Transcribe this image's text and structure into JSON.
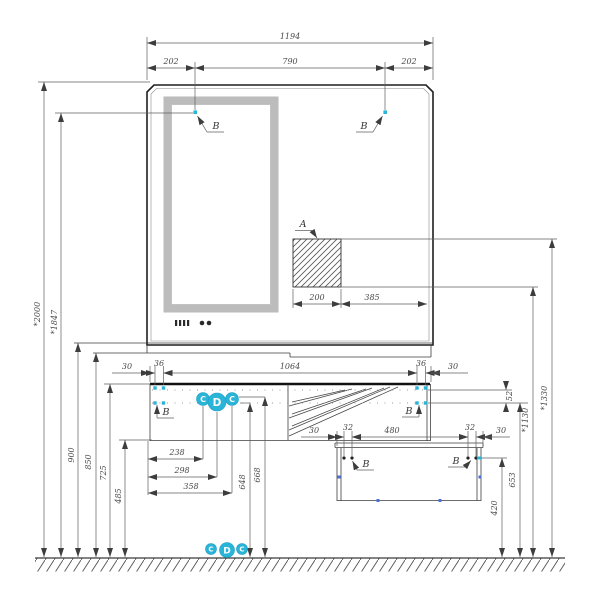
{
  "drawing": {
    "callouts": {
      "a": "A",
      "b": "B",
      "c": "C",
      "d": "D"
    },
    "top_dims": {
      "total": "1194",
      "left": "202",
      "center": "790",
      "right": "202"
    },
    "hatch_dims": {
      "width": "200",
      "offset": "385"
    },
    "under_dims": {
      "left_30": "30",
      "left_36": "36",
      "span": "1064",
      "right_36": "36",
      "right_30": "30"
    },
    "left_heights": {
      "top": "*2000",
      "mount": "*1847",
      "counter": "900",
      "ledge": "850",
      "worktop": "725",
      "bottom": "485"
    },
    "bottom_dims": {
      "w238": "238",
      "w298": "298",
      "w358": "358",
      "h648": "648",
      "h668": "668"
    },
    "cabinet_dims": {
      "left_30": "30",
      "left_32": "32",
      "span": "480",
      "right_32": "32",
      "right_30": "30"
    },
    "right_heights": {
      "gap": "52",
      "row": "653",
      "cab": "420",
      "mid": "*1130",
      "high": "*1330"
    }
  },
  "colors": {
    "accent": "#29b4d8",
    "line": "#3d3d3d",
    "frame": "#bcbcbc"
  }
}
